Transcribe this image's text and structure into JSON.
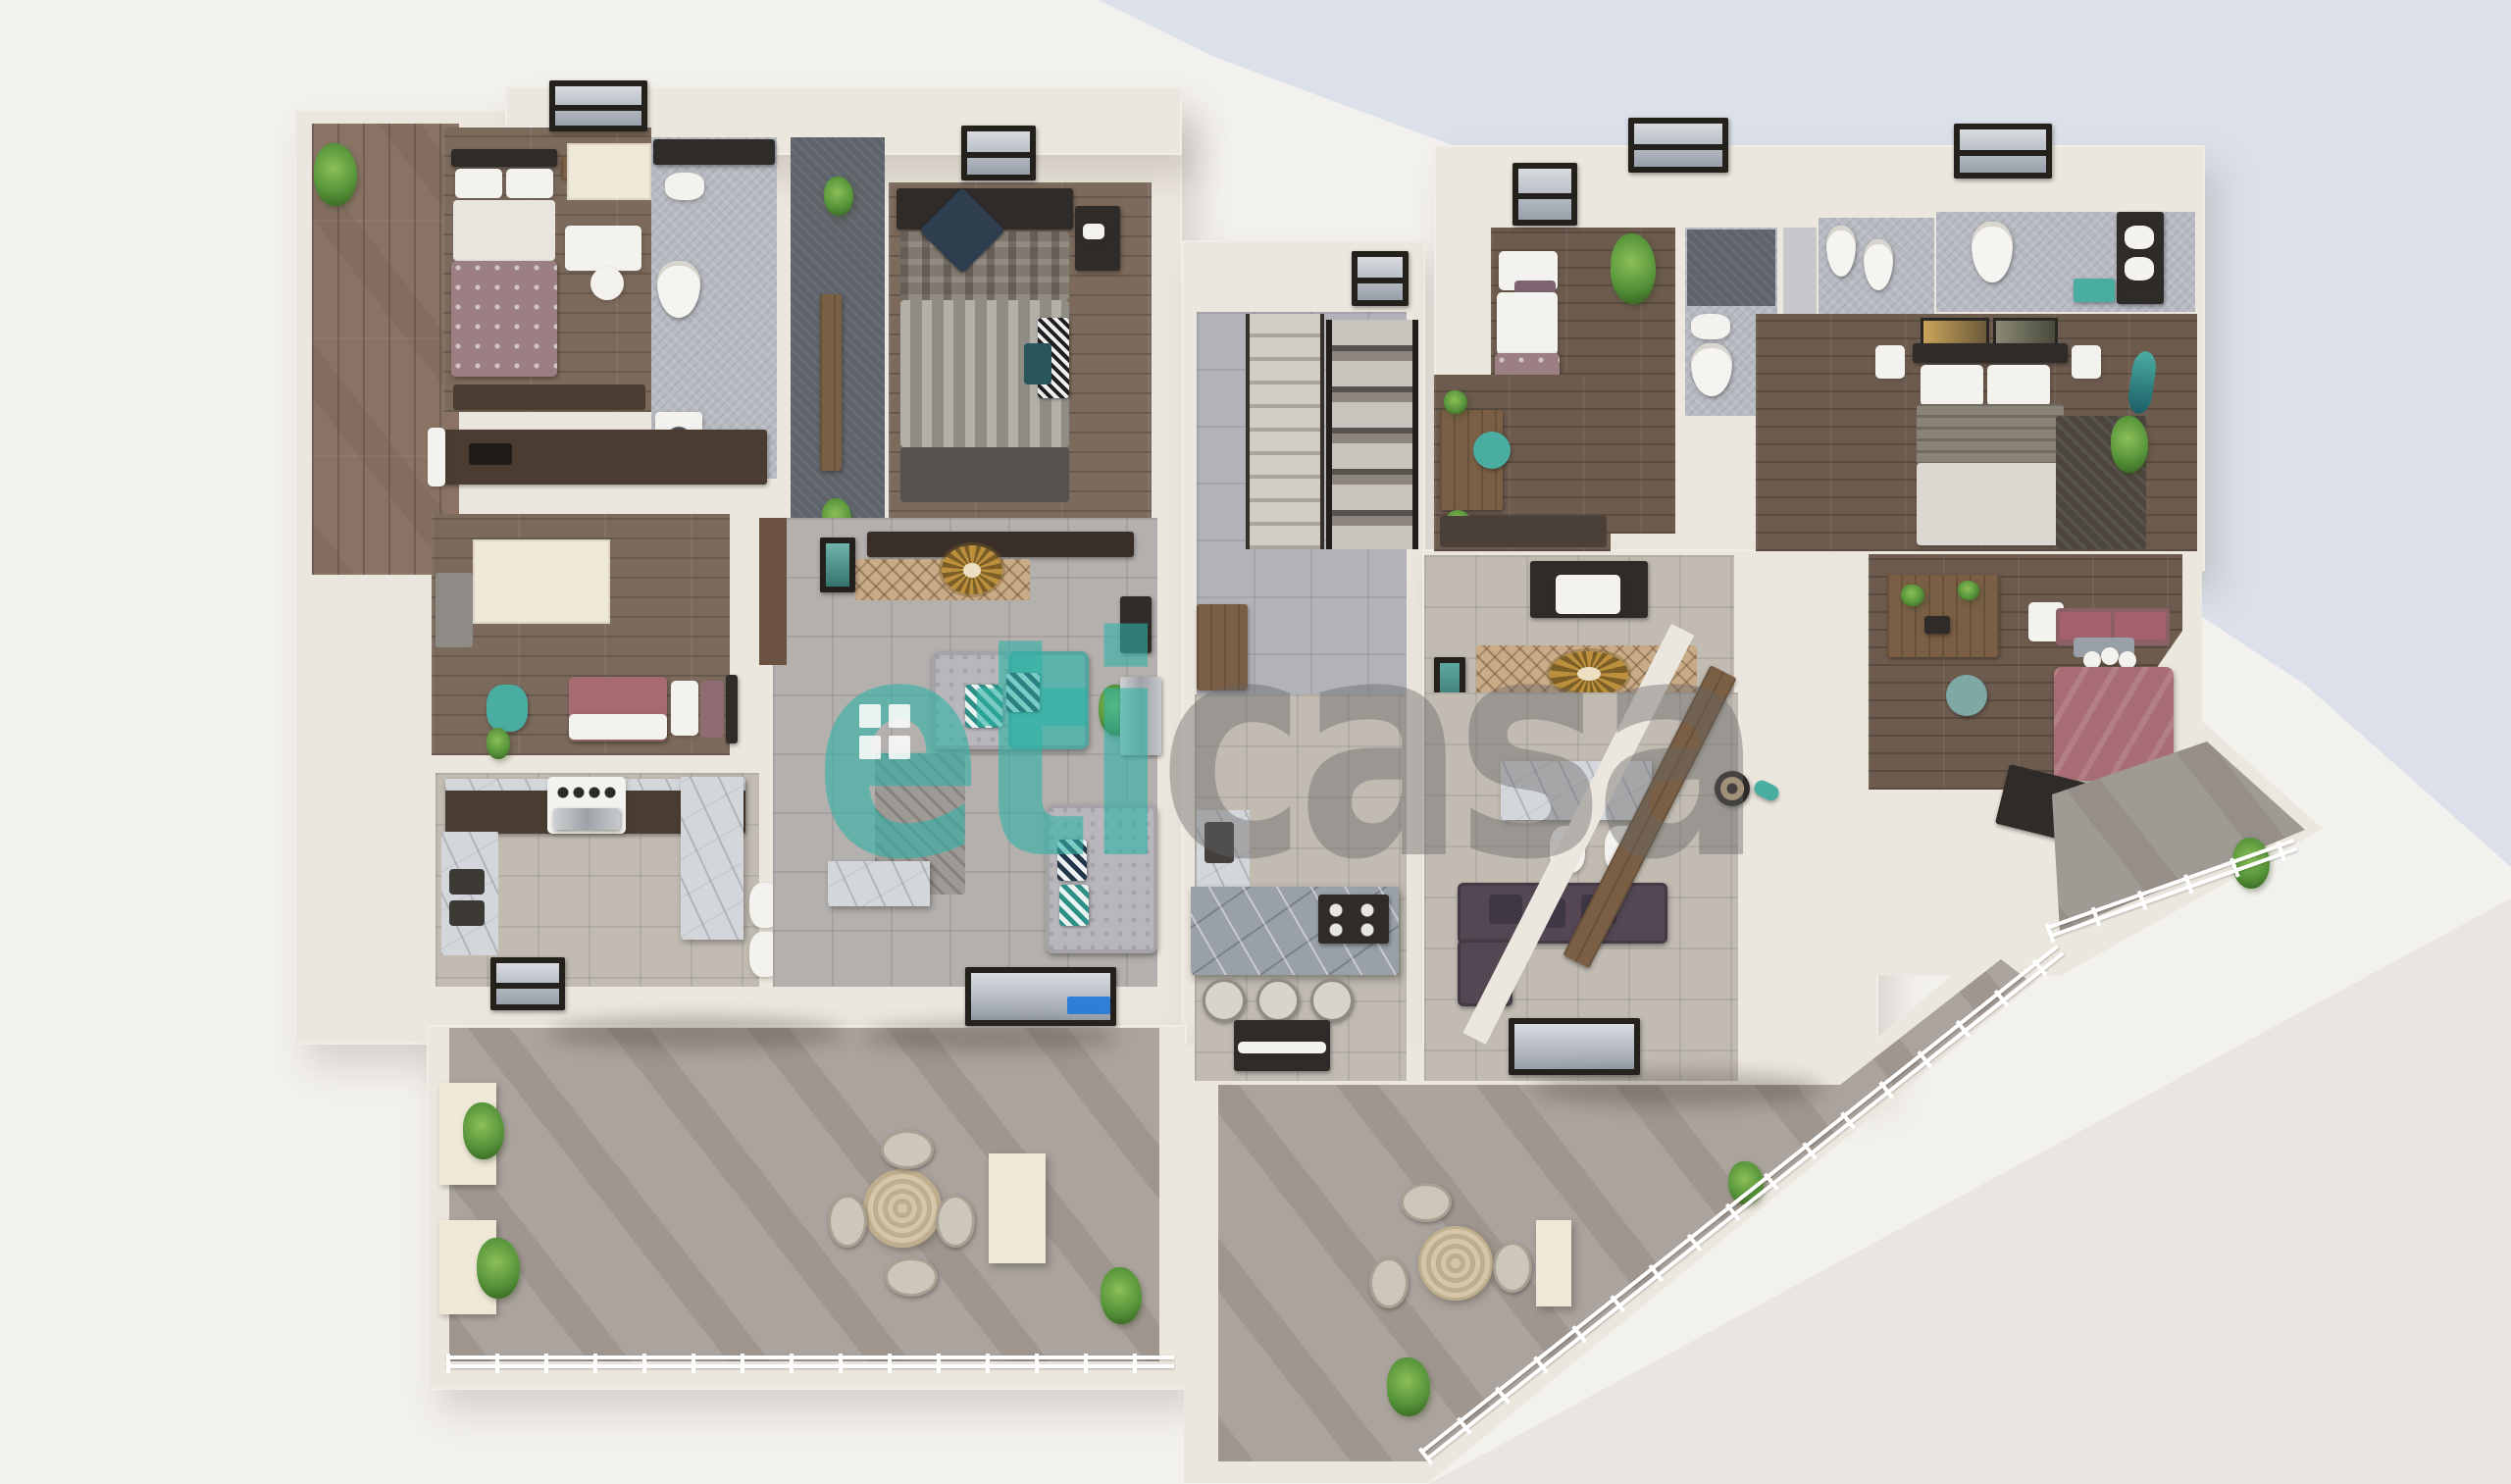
{
  "meta": {
    "image_type": "photorealistic 3D top-down floor-plan rendering of a residential storey",
    "visible_text": "eticasa"
  },
  "watermark": {
    "text": "eticasa",
    "part1": "eti",
    "part2": "casa",
    "part1_color": "#2fb3a6",
    "part2_color": "#646464",
    "icon": "house-window-icon"
  },
  "palette": {
    "background_warm": "#f3f1ee",
    "background_sky": "#dbe0ea",
    "walls": "#ece7de",
    "sunlit_wall": "#f6efe3",
    "wood_floor_light": "#7c6a5c",
    "wood_floor_dark": "#6d5b4e",
    "balcony_deck": "#8a7365",
    "tile_gray": "#b3b0ad",
    "tile_beige": "#c1bbb2",
    "bathroom_stone": "#b7bac1",
    "slate": "#5f646a",
    "marble_light": "#d3d6da",
    "marble_dark": "#99a0a8",
    "terrace_paving": "#aba39d",
    "accent_teal": "#4aada2",
    "sofa_purple": "#544753",
    "bed_mauve": "#a56b70",
    "plant_green": "#55933a",
    "window_frame": "#24211d",
    "glass_blue": "#2f7fd6",
    "mosaic_gold": "#bb8f3c"
  },
  "scene": {
    "left_apartment_rooms": [
      "side-balcony",
      "bedroom",
      "bathroom",
      "shower-room",
      "master-bedroom",
      "kitchenette-corridor",
      "second-bedroom",
      "kitchen",
      "living-dining-room",
      "terrace"
    ],
    "core_rooms": [
      "hallway",
      "double-staircase"
    ],
    "right_apartment_rooms": [
      "bedroom",
      "bathroom",
      "guest-bathroom",
      "ensuite-bathroom",
      "master-bedroom",
      "study",
      "entry-foyer",
      "open-kitchen",
      "living-dining-room",
      "kids-bedroom",
      "angled-terrace",
      "terrace"
    ],
    "furniture": [
      "beds",
      "sofas",
      "dining-tables",
      "kitchen-island",
      "stools",
      "desks",
      "chairs",
      "toilets",
      "sinks",
      "washing-machine",
      "wardrobes",
      "outdoor-round-tables",
      "planters",
      "rugs"
    ],
    "outdoor": [
      "white-railings",
      "potted-plants",
      "sun-shadow-stripes"
    ]
  }
}
